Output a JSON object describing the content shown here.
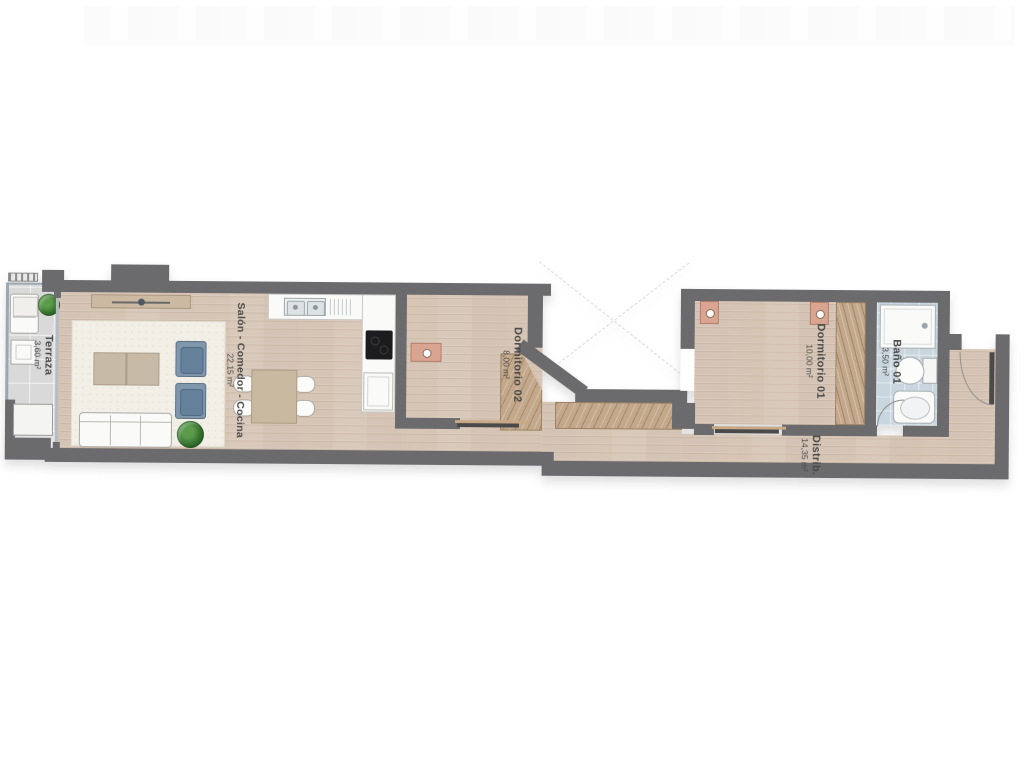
{
  "plan": {
    "type": "apartment-floor-plan",
    "rooms": {
      "terraza": {
        "name": "Terraza",
        "area": "3,60 m²"
      },
      "salon": {
        "name": "Salón - Comedor - Cocina",
        "area": "22,15 m²"
      },
      "dorm02": {
        "name": "Dormitorio 02",
        "area": "8,00 m²"
      },
      "dorm01": {
        "name": "Dormitorio 01",
        "area": "10,00 m²"
      },
      "bano": {
        "name": "Baño 01",
        "area": "3,50 m²"
      },
      "distrib": {
        "name": "Distrib.",
        "area": "14,35 m²"
      }
    },
    "colors": {
      "wall": "#6b6b6d",
      "wood_floor": "#dccdbf",
      "terrace_tile": "#d9d9d9",
      "bath_tile": "#c9d6df",
      "wardrobe": "#c3a88b",
      "armchair": "#8097ab",
      "nightstand": "#d9a490",
      "label_text": "#4a4a4a"
    },
    "fixtures": [
      "lounge-chair",
      "terrace-plant",
      "terrace-table",
      "ac-unit",
      "sofa",
      "armchair",
      "armchair",
      "coffee-tables",
      "living-plant",
      "sideboard-tv",
      "dining-table",
      "dining-chairs",
      "kitchen-sink",
      "cooktop",
      "oven",
      "single-bed",
      "single-bed",
      "nightstand-lamp",
      "double-bed",
      "nightstand-lamp",
      "nightstand-lamp",
      "wardrobe",
      "corridor-closet",
      "shower",
      "toilet",
      "washbasin",
      "entrance-door",
      "bath-door",
      "sliding-door",
      "sliding-door",
      "light-well"
    ]
  }
}
